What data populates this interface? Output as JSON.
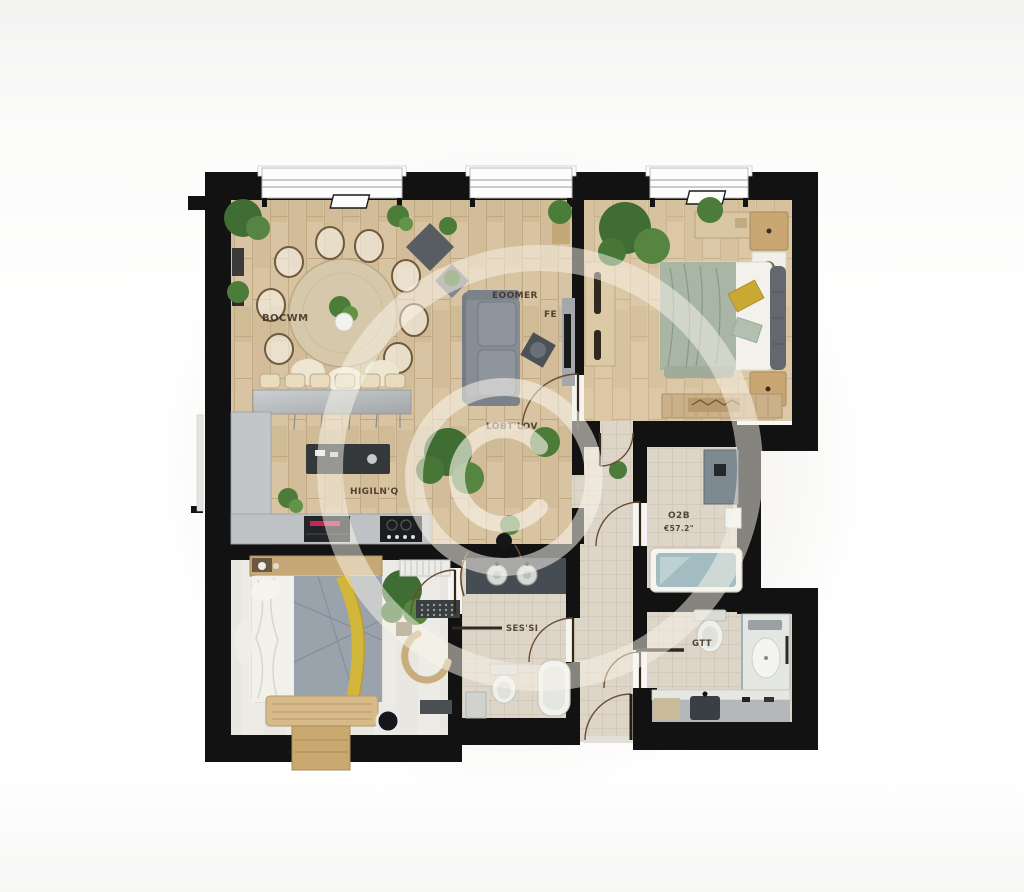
{
  "image_type": "photorealistic apartment floor plan render, top-down view",
  "watermark": {
    "symbol": "©"
  },
  "labels": {
    "dining": "BOCWM",
    "living_a": "EOOMER",
    "living_b": "FE",
    "living_c": "LOBT'LOV",
    "kitchen": "HIGILN'Q",
    "bathroom_main_a": "O2B",
    "bathroom_main_b": "€57.2\"",
    "bathroom_small": "SES'SI",
    "bathroom_ensuite": "GTT"
  },
  "palette": {
    "wall": "#121212",
    "wood_floor": "#d6c1a0",
    "tile_floor": "#ddd5c7",
    "bedroom2_floor": "#ecebe5",
    "counter_gray": "#c3c6c8",
    "sofa_gray": "#878d95",
    "blanket_sage": "#a9b6a5",
    "pillow_yellow": "#c9a833",
    "quilt_gray": "#9aa3ac",
    "quilt_yellow": "#d2b63a",
    "tub_water": "#a3bcc1",
    "plant_green": "#4c7c3a",
    "oven_display_pink": "#d8255f",
    "watermark_cream": "rgba(250,246,236,0.55)"
  }
}
